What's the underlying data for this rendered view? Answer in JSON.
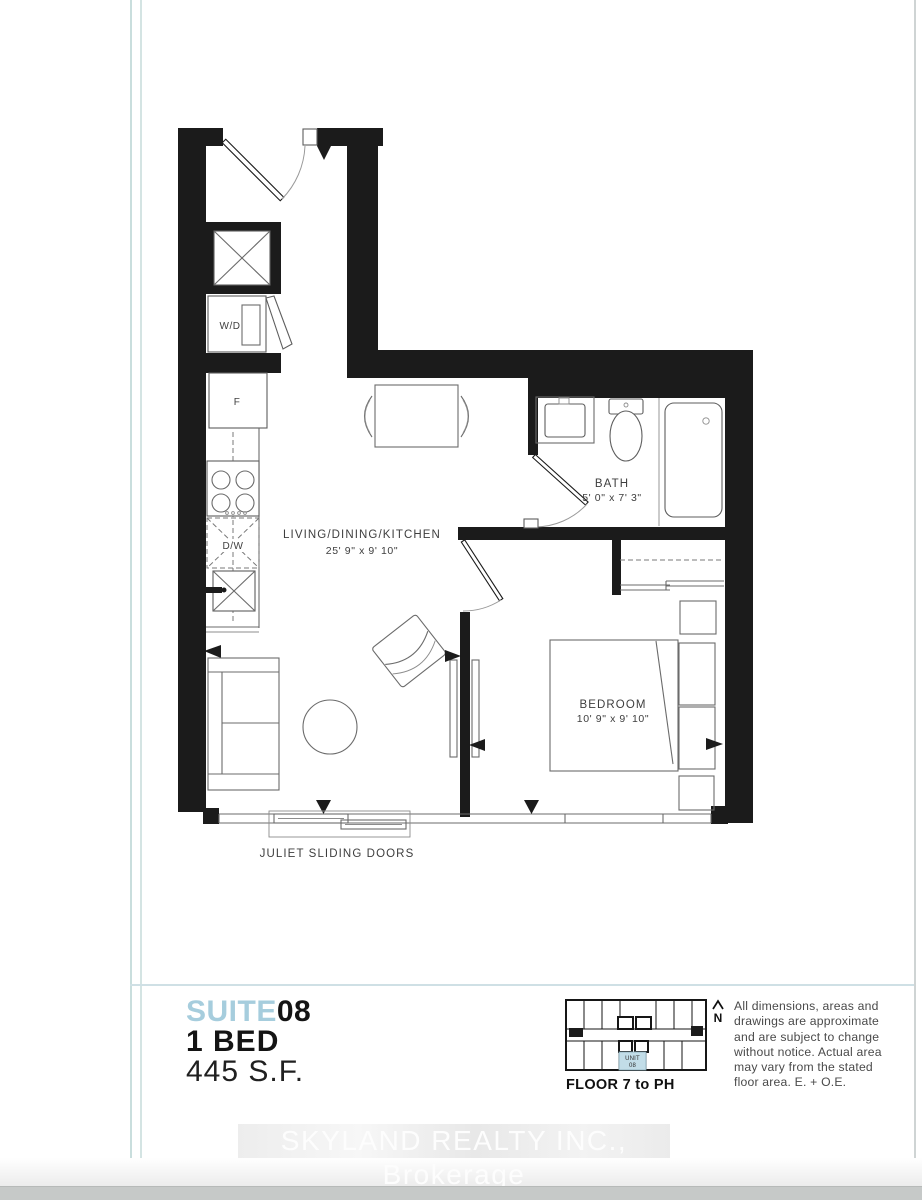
{
  "page": {
    "watermark": "SKYLAND REALTY INC., Brokerage"
  },
  "suite": {
    "label": "SUITE",
    "number": "08",
    "type": "1 BED",
    "area": "445 S.F."
  },
  "plan": {
    "living": {
      "name": "LIVING/DINING/KITCHEN",
      "dims": "25' 9\" x 9' 10\""
    },
    "bath": {
      "name": "BATH",
      "dims": "5' 0\" x 7' 3\""
    },
    "bedroom": {
      "name": "BEDROOM",
      "dims": "10' 9\" x 9' 10\""
    },
    "juliet_label": "JULIET SLIDING DOORS",
    "appliances": {
      "washer_dryer": "W/D",
      "fridge": "F",
      "dishwasher": "D/W"
    }
  },
  "keyplan": {
    "floor_label": "FLOOR 7 to PH",
    "unit_line1": "UNIT",
    "unit_line2": "08",
    "north_label": "N"
  },
  "disclaimer": {
    "lines": [
      "All dimensions, areas and",
      "drawings are approximate",
      "and are subject to change",
      "without notice. Actual area",
      "may vary from the stated",
      "floor area. E. + O.E."
    ]
  },
  "colors": {
    "accent": "#a6cddd",
    "wall": "#1b1b1b",
    "keyplan_highlight": "#c2dde8"
  }
}
